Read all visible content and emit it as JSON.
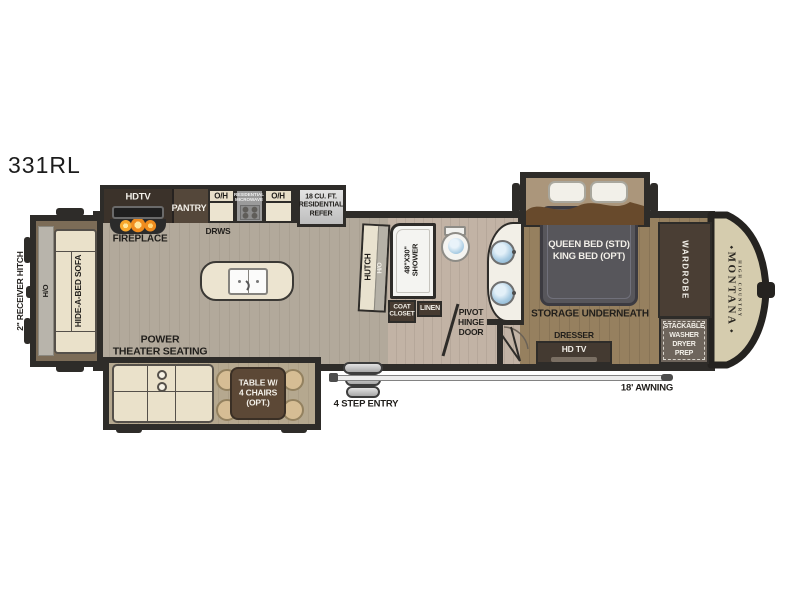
{
  "plan": {
    "model": "331RL",
    "brand": {
      "name": "MONTANA",
      "sub": "HIGH COUNTRY",
      "ornament": "◆"
    },
    "colors": {
      "wall": "#2e2c29",
      "floor_living": "#b2a99b",
      "floor_bath": "#c2b3a5",
      "floor_bedroom": "#96805f",
      "floor_slide": "#b5a88f",
      "cream_cabinet": "#ece4d0",
      "dark_cabinet": "#473b31",
      "nose_cap": "#d5ccae",
      "flame_orange": "#f08c1e",
      "sink_blue": "#8fb8d8"
    },
    "front": {
      "hitch": "2\" RECEIVER HITCH",
      "ho": "H/O",
      "sofa": "HIDE-A-BED SOFA"
    },
    "kitchen": {
      "hdtv": "HDTV",
      "fireplace": "FIREPLACE",
      "pantry": "PANTRY",
      "oh": "O/H",
      "micro_lines": [
        "RESIDENTIAL",
        "MICROWAVE"
      ],
      "drws": "DRWS",
      "refer_lines": [
        "18 CU. FT.",
        "RESIDENTIAL",
        "REFER"
      ],
      "hutch": "HUTCH",
      "hutch_oh": "H/O"
    },
    "bath": {
      "shower_lines": [
        "48\"X30\"",
        "SHOWER"
      ],
      "coat_lines": [
        "COAT",
        "CLOSET"
      ],
      "linen": "LINEN",
      "pivot_lines": [
        "PIVOT",
        "HINGE",
        "DOOR"
      ]
    },
    "bedroom": {
      "bed_lines": [
        "QUEEN BED (STD)",
        "KING BED (OPT)"
      ],
      "storage": "STORAGE  UNDERNEATH",
      "dresser": "DRESSER",
      "hdtv": "HD TV",
      "wardrobe": "WARDROBE",
      "stack_lines": [
        "STACKABLE",
        "WASHER",
        "DRYER",
        "PREP"
      ]
    },
    "rear_slide": {
      "theater_lines": [
        "POWER",
        "THEATER SEATING"
      ],
      "table_lines": [
        "TABLE W/",
        "4 CHAIRS",
        "(OPT.)"
      ]
    },
    "exterior": {
      "steps": "4 STEP ENTRY",
      "awning": "18' AWNING"
    }
  }
}
